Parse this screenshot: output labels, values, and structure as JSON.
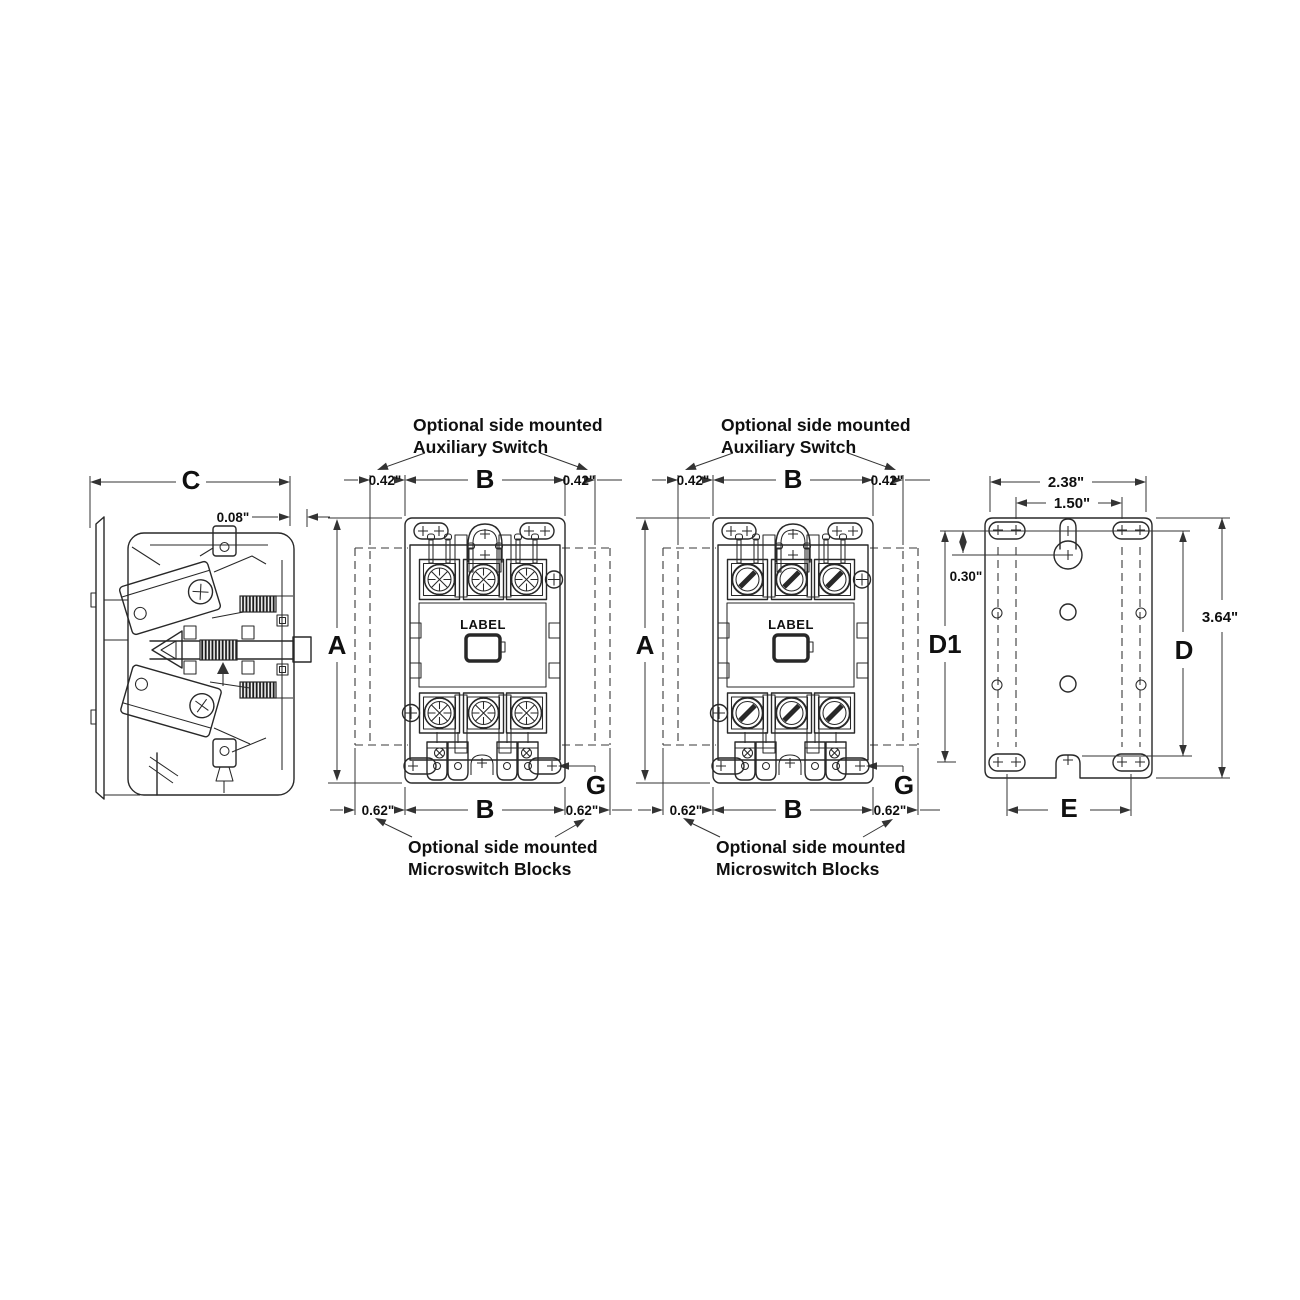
{
  "side_view": {
    "dim_depth": "C",
    "dim_gap": "0.08\""
  },
  "front_view_1": {
    "note_top_line1": "Optional side mounted",
    "note_top_line2": "Auxiliary Switch",
    "dim_height": "A",
    "dim_width_top": "B",
    "dim_width_bottom": "B",
    "dim_aux_left": "0.42\"",
    "dim_aux_right": "0.42\"",
    "dim_micro_left": "0.62\"",
    "dim_micro_right": "0.62\"",
    "dim_terminal": "G",
    "device_label": "LABEL",
    "note_bottom_line1": "Optional side mounted",
    "note_bottom_line2": "Microswitch Blocks"
  },
  "front_view_2": {
    "note_top_line1": "Optional side mounted",
    "note_top_line2": "Auxiliary Switch",
    "dim_height": "A",
    "dim_width_top": "B",
    "dim_width_bottom": "B",
    "dim_aux_left": "0.42\"",
    "dim_aux_right": "0.42\"",
    "dim_micro_left": "0.62\"",
    "dim_micro_right": "0.62\"",
    "dim_terminal": "G",
    "device_label": "LABEL",
    "note_bottom_line1": "Optional side mounted",
    "note_bottom_line2": "Microswitch Blocks"
  },
  "mounting_plate_view": {
    "dim_slot_outer": "2.38\"",
    "dim_slot_inner": "1.50\"",
    "dim_keyhole_offset": "0.30\"",
    "dim_d1": "D1",
    "dim_d": "D",
    "dim_overall_height": "3.64\"",
    "dim_bottom_slots": "E"
  }
}
